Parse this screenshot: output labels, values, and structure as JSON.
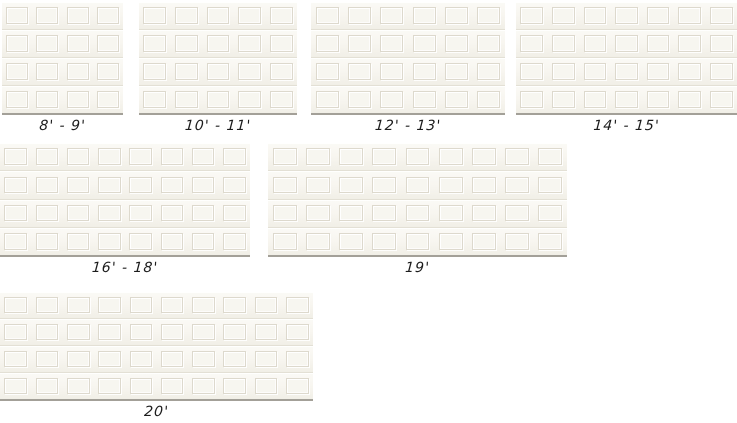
{
  "page": {
    "background": "#ffffff",
    "description_colors": {
      "door_surface": "#f7f5ef",
      "panel_groove": "#ddd9cd",
      "section_seam": "#e3e0d5",
      "door_bottom_edge": "#a3a098",
      "label_text": "#1c1c1c"
    }
  },
  "doors": [
    {
      "name": "8-9",
      "label": "8' -  9'",
      "columns": 4,
      "rows": 4,
      "geometry": {
        "left": 2,
        "top": 2,
        "width": 121,
        "height": 113
      }
    },
    {
      "name": "10-11",
      "label": "10' -  11'",
      "columns": 5,
      "rows": 4,
      "geometry": {
        "left": 139,
        "top": 2,
        "width": 158,
        "height": 113
      }
    },
    {
      "name": "12-13",
      "label": "12' -  13'",
      "columns": 6,
      "rows": 4,
      "geometry": {
        "left": 311,
        "top": 2,
        "width": 194,
        "height": 113
      }
    },
    {
      "name": "14-15",
      "label": "14' -  15'",
      "columns": 7,
      "rows": 4,
      "geometry": {
        "left": 516,
        "top": 2,
        "width": 221,
        "height": 113
      }
    },
    {
      "name": "16-18",
      "label": "16' -  18'",
      "columns": 8,
      "rows": 4,
      "geometry": {
        "left": 0,
        "top": 143,
        "width": 250,
        "height": 114
      }
    },
    {
      "name": "19",
      "label": "19'",
      "columns": 9,
      "rows": 4,
      "geometry": {
        "left": 268,
        "top": 143,
        "width": 299,
        "height": 114
      }
    },
    {
      "name": "20",
      "label": "20'",
      "columns": 10,
      "rows": 4,
      "geometry": {
        "left": 0,
        "top": 292,
        "width": 313,
        "height": 109
      }
    }
  ]
}
